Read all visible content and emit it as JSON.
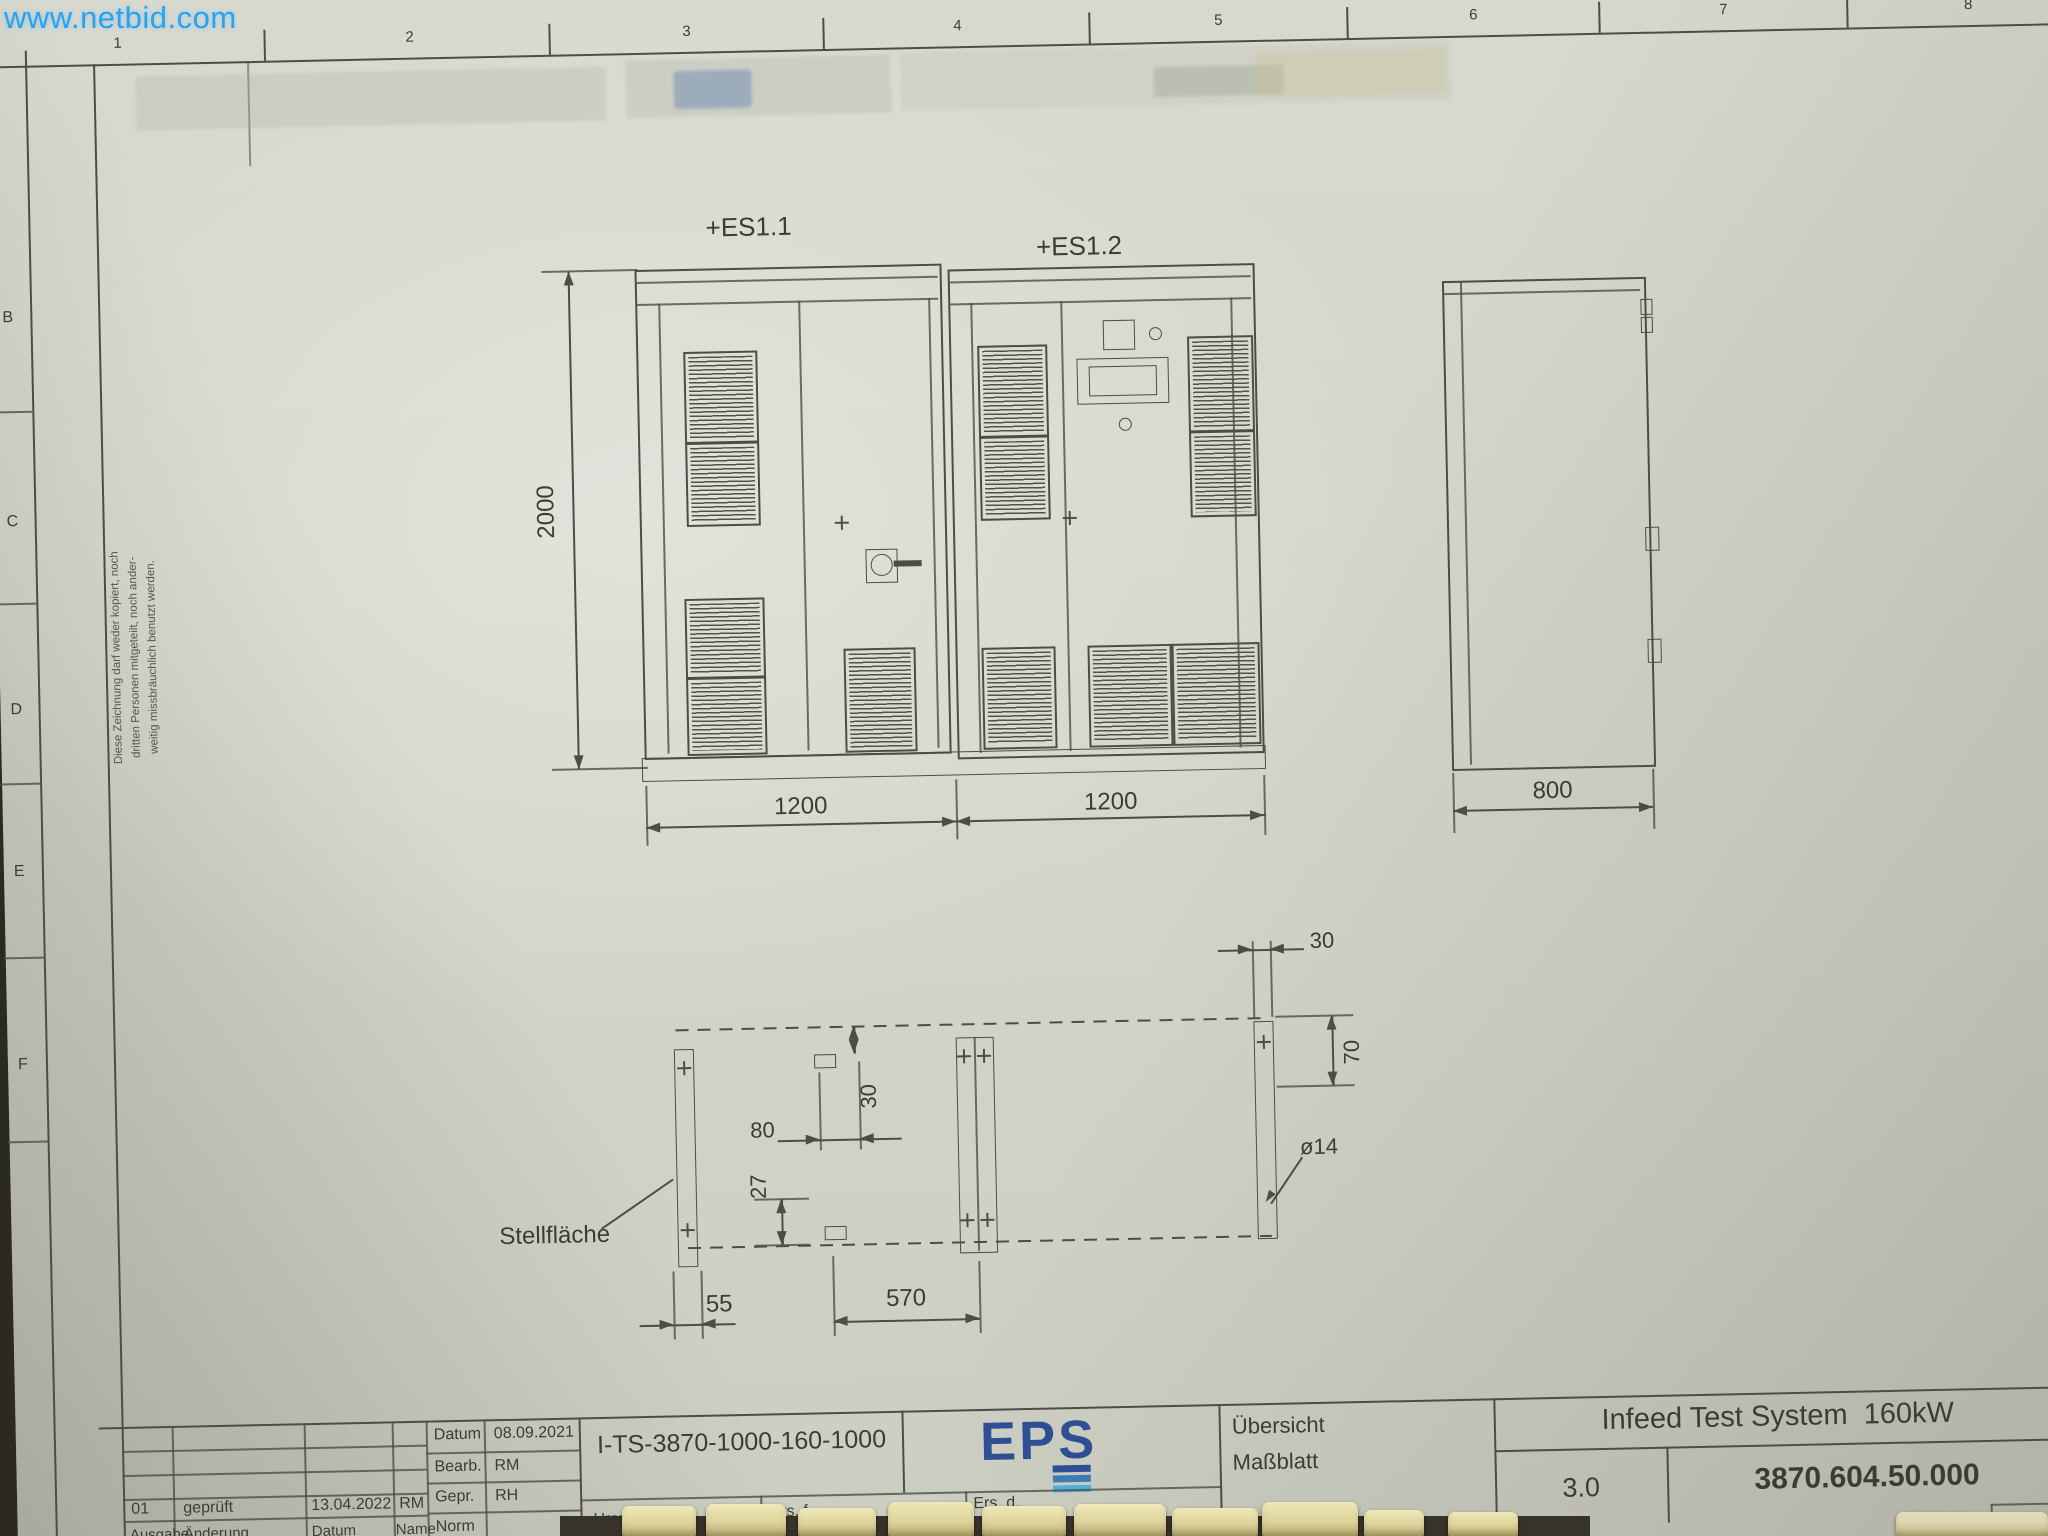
{
  "watermark": {
    "text": "www.netbid.com"
  },
  "grid": {
    "columns": [
      "1",
      "2",
      "3",
      "4",
      "5",
      "6",
      "7",
      "8"
    ],
    "rows": [
      "B",
      "C",
      "D",
      "E",
      "F"
    ]
  },
  "disclaimer": {
    "line1": "Diese Zeichnung darf weder kopiert, noch",
    "line2": "dritten Personen mitgeteilt, noch ander-",
    "line3": "weitig missbräuchlich benutzt werden."
  },
  "front_view": {
    "cabinet1_label": "+ES1.1",
    "cabinet2_label": "+ES1.2",
    "height": "2000",
    "width1": "1200",
    "width2": "1200",
    "depth": "800"
  },
  "plan_view": {
    "area_label": "Stellfläche",
    "rail_width": "30",
    "edge_offset": "70",
    "cutout_offset_h": "80",
    "cutout_offset_v": "30",
    "cutout_bottom_offset": "27",
    "front_offset": "55",
    "cutout_spacing": "570",
    "hole_diameter": "ø14"
  },
  "title_block": {
    "info_rows": [
      {
        "label": "Datum",
        "value": "08.09.2021"
      },
      {
        "label": "Bearb.",
        "value": "RM"
      },
      {
        "label": "Gepr.",
        "value": "RH"
      },
      {
        "label": "Norm",
        "value": ""
      }
    ],
    "revision_row": {
      "issue": "01",
      "change": "geprüft",
      "date": "13.04.2022",
      "name": "RM"
    },
    "revision_header": {
      "issue": "Ausgabe",
      "change": "Änderung",
      "date": "Datum",
      "name": "Name"
    },
    "drawing_id": "I-TS-3870-1000-160-1000",
    "logo_text": "EPS",
    "origin_label": "Urspr.",
    "replaces_label": "Ers. f.",
    "replaced_by_label": "Ers. d.",
    "doc_type_line1": "Übersicht",
    "doc_type_line2": "Maßblatt",
    "title": "Infeed Test System  160kW",
    "version": "3.0",
    "part_number": "3870.604.50.000"
  },
  "colors": {
    "accent_blue": "#2e4f93",
    "accent_lightblue": "#4fb0dc",
    "watermark_blue": "#1ea2f2",
    "line": "#4d4d45",
    "paper": "#d4d5ca"
  }
}
